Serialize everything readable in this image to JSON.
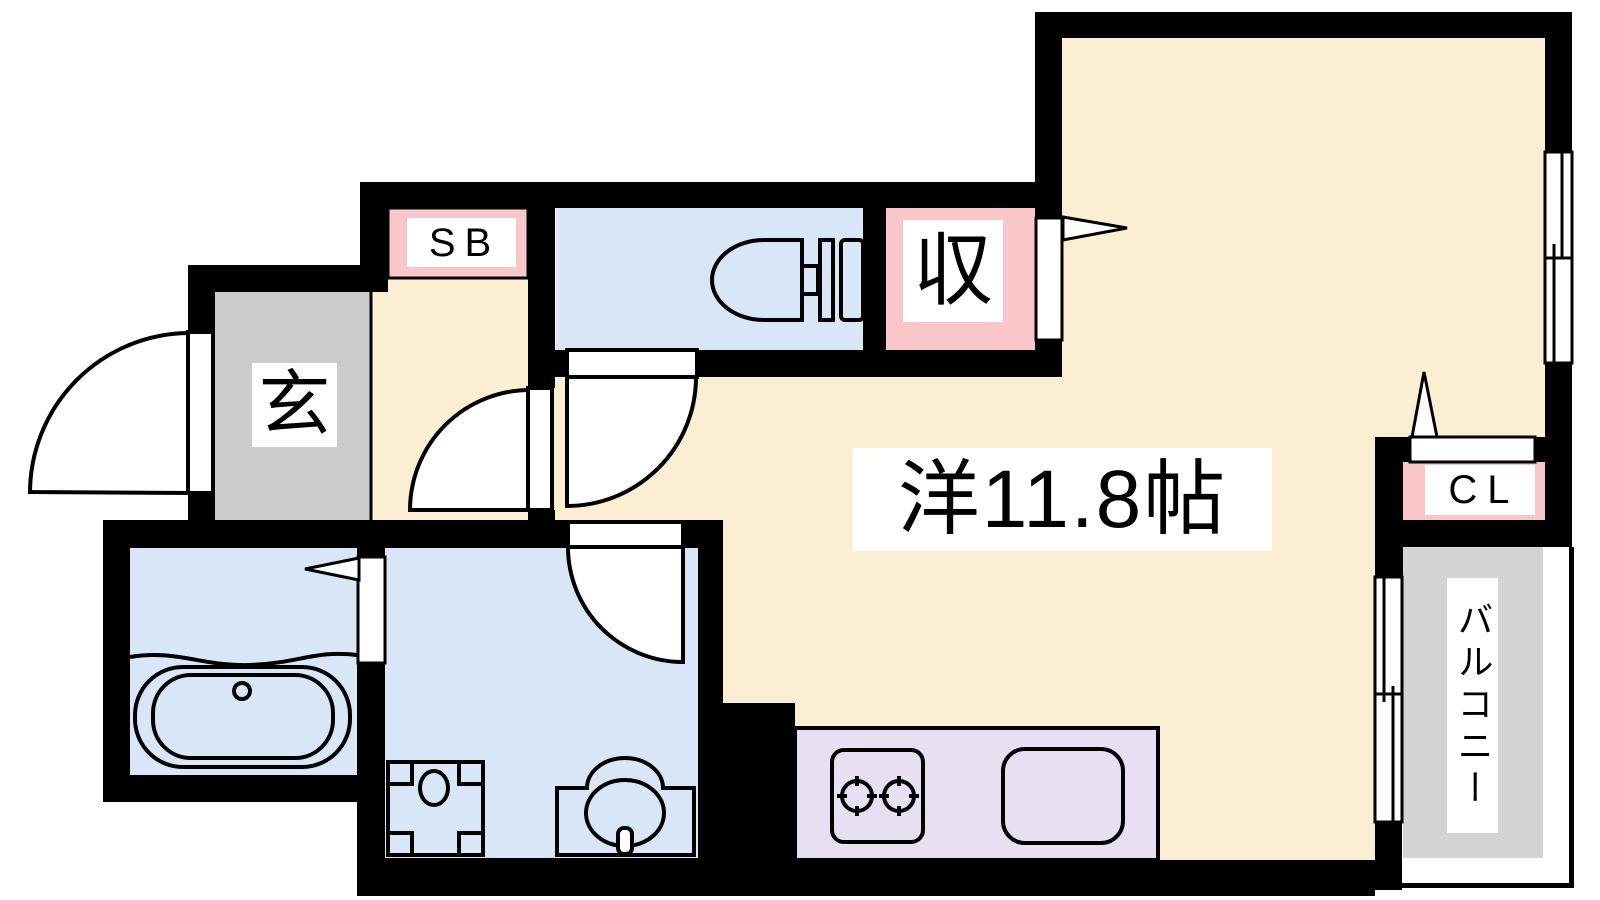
{
  "labels": {
    "shoe_box": "SB",
    "entrance": "玄",
    "storage": "収",
    "closet": "CL",
    "main_room": "洋11.8帖",
    "balcony": "バルコニー"
  },
  "colors": {
    "wall": "#000000",
    "background": "#FFFFFF",
    "main_room_floor": "#FBEED2",
    "wet_area_floor": "#D8E6F8",
    "storage_accent": "#F9C6C9",
    "entrance_floor": "#CBCBCB",
    "balcony_floor": "#D4D4D4",
    "kitchen_counter": "#E7DFF2",
    "label_background": "#FFFFFF",
    "label_text": "#000000"
  }
}
